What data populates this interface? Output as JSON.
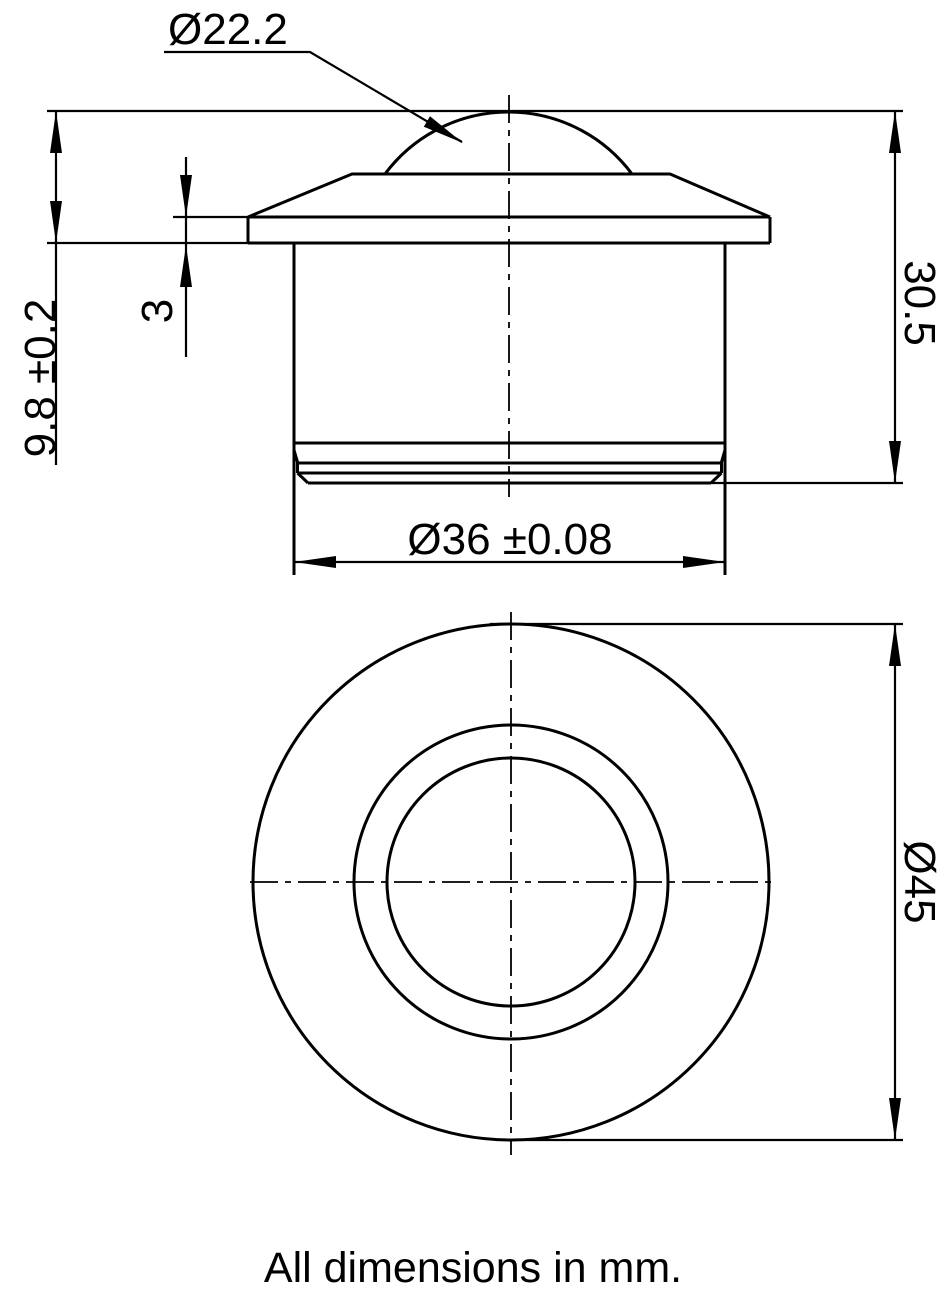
{
  "sheet": {
    "background": "#ffffff",
    "line_color": "#000000",
    "caption": "All dimensions in mm."
  },
  "side_view": {
    "labels": {
      "ball_diameter": "Ø22.2",
      "protrusion_height": "9.8 ±0.2",
      "plate_thickness": "3",
      "overall_height": "30.5",
      "body_diameter": "Ø36 ±0.08"
    }
  },
  "plan_view": {
    "labels": {
      "flange_diameter": "Ø45"
    }
  }
}
